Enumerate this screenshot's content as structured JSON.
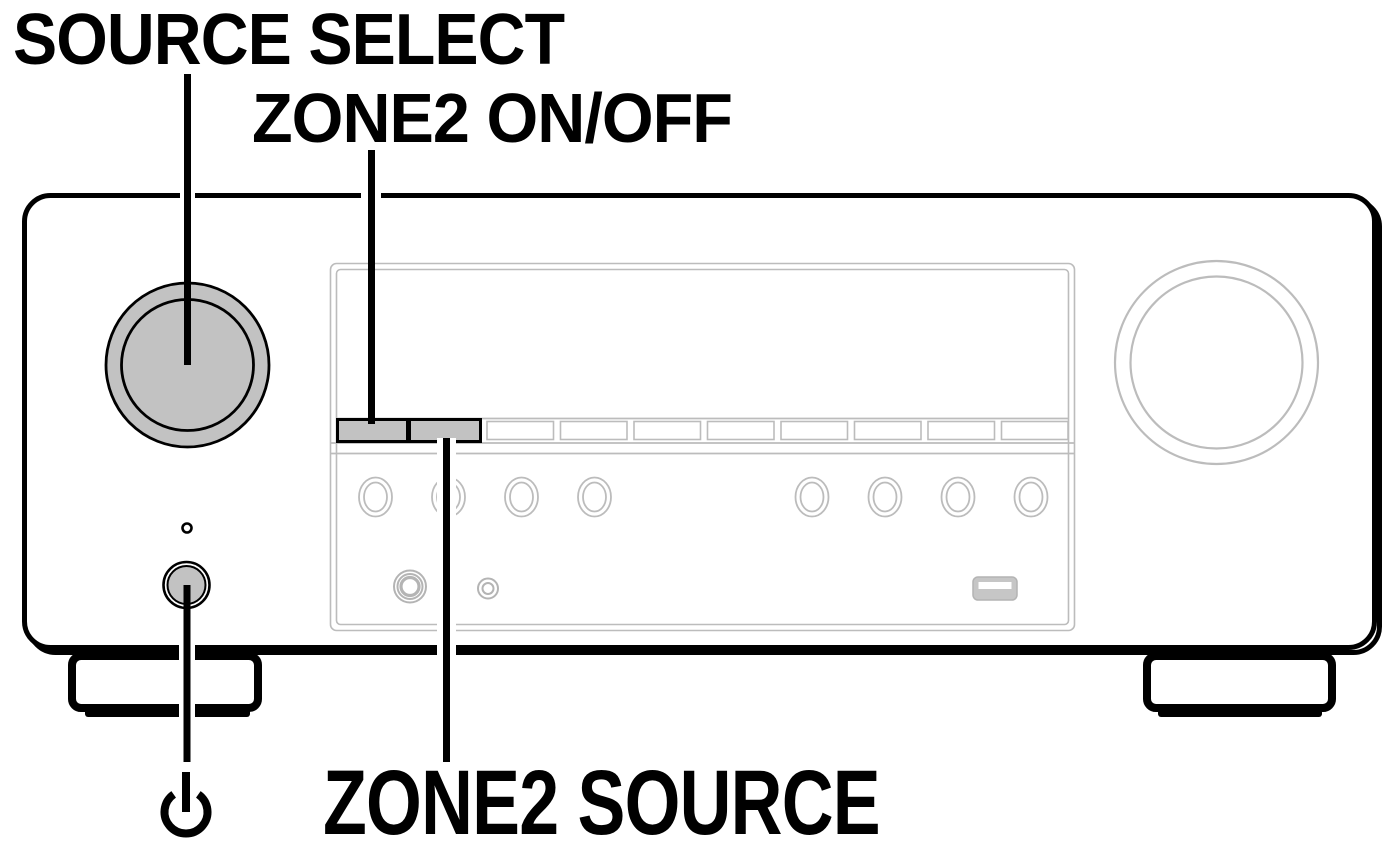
{
  "colors": {
    "label-color": "#000000",
    "outline": "#000000",
    "art-gray": "#bcbcbc",
    "fill-gray": "#c2c2c2",
    "bg": "#ffffff"
  },
  "labels": {
    "source_select": "SOURCE SELECT",
    "zone2_on_off": "ZONE2 ON/OFF",
    "zone2_source": "ZONE2 SOURCE"
  },
  "icons": {
    "power": "power-standby-icon"
  },
  "callouts": [
    {
      "label": "SOURCE SELECT",
      "points_to": "source-select-knob"
    },
    {
      "label": "ZONE2 ON/OFF",
      "points_to": "zone2-on-off-button"
    },
    {
      "label": "ZONE2 SOURCE",
      "points_to": "zone2-source-button"
    },
    {
      "label": "power symbol",
      "points_to": "power-button"
    }
  ]
}
